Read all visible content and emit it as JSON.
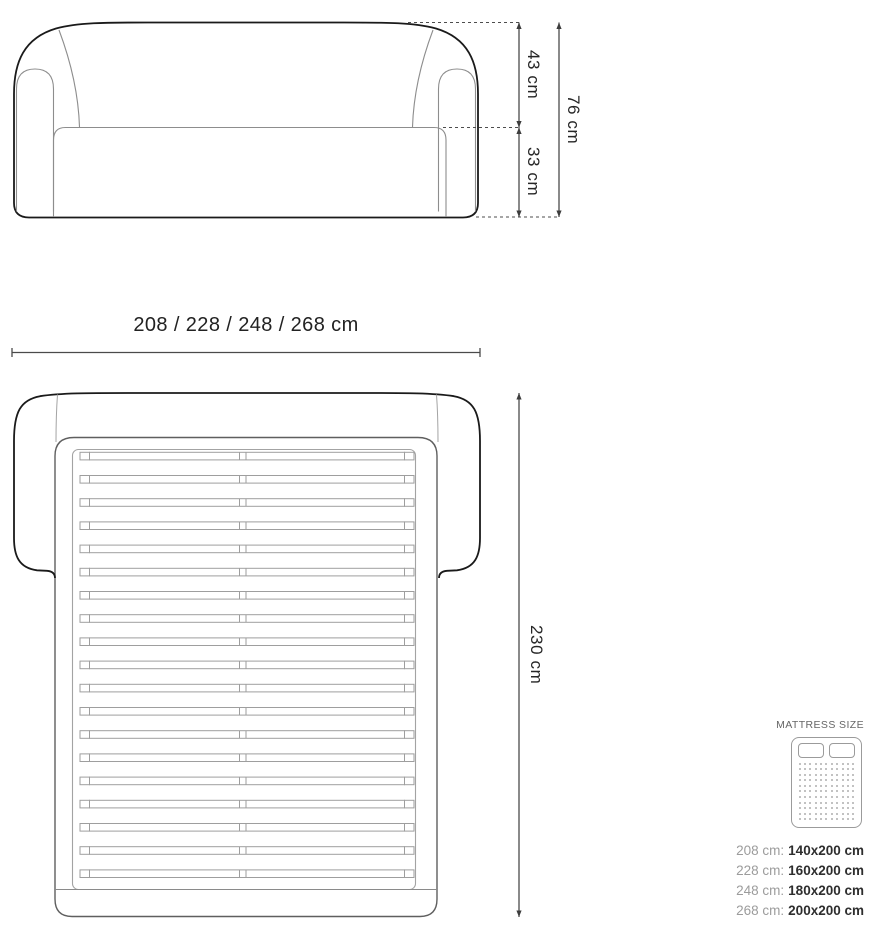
{
  "front_view": {
    "dim_back_height": "43 cm",
    "dim_seat_height": "33 cm",
    "dim_total_height": "76 cm"
  },
  "width_dimension": {
    "label": "208 / 228 / 248 / 268 cm"
  },
  "top_view": {
    "dim_depth": "230 cm",
    "slat_count": 19
  },
  "mattress_panel": {
    "title": "MATTRESS SIZE",
    "icon": "mattress-icon",
    "dot_cols": 11,
    "dot_rows": 11,
    "sizes": [
      {
        "label": "208 cm:",
        "value": "140x200 cm"
      },
      {
        "label": "228 cm:",
        "value": "160x200 cm"
      },
      {
        "label": "248 cm:",
        "value": "180x200 cm"
      },
      {
        "label": "268 cm:",
        "value": "200x200 cm"
      }
    ]
  },
  "colors": {
    "outline": "#1a1a1a",
    "inner_line": "#8d8d8d",
    "dim_line": "#3d3d3d",
    "text": "#262626",
    "muted": "#9c9c9c"
  }
}
